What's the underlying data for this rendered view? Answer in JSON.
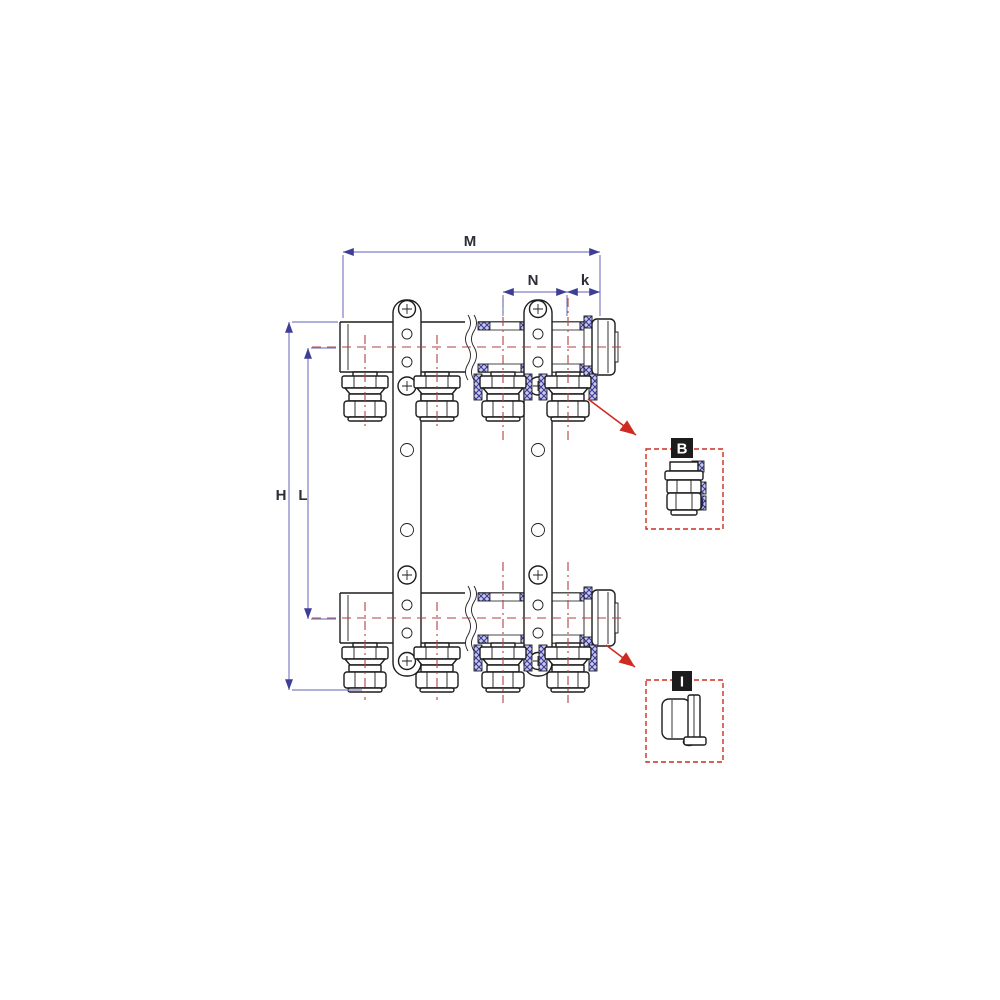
{
  "drawing": {
    "type": "technical-drawing",
    "subject": "floor-heating manifold pair with mounting brackets, outlet compression fittings and end caps"
  },
  "dimensions": {
    "m": "M",
    "n": "N",
    "k": "k",
    "h": "H",
    "l": "L"
  },
  "callouts": {
    "b": "B",
    "i": "I"
  },
  "colors": {
    "outline": "#1d1d1d",
    "dimension": "#7f7fc2",
    "dimension-dark": "#3e3e96",
    "centerline": "#b24040",
    "callout": "#cf2b20",
    "badge": "#1c1c1c",
    "label": "#2e2e38",
    "accent-dark": "#2a2ab0",
    "hatch-line": "#3a3a9a",
    "hatch-bg": "#c9c9ec"
  }
}
